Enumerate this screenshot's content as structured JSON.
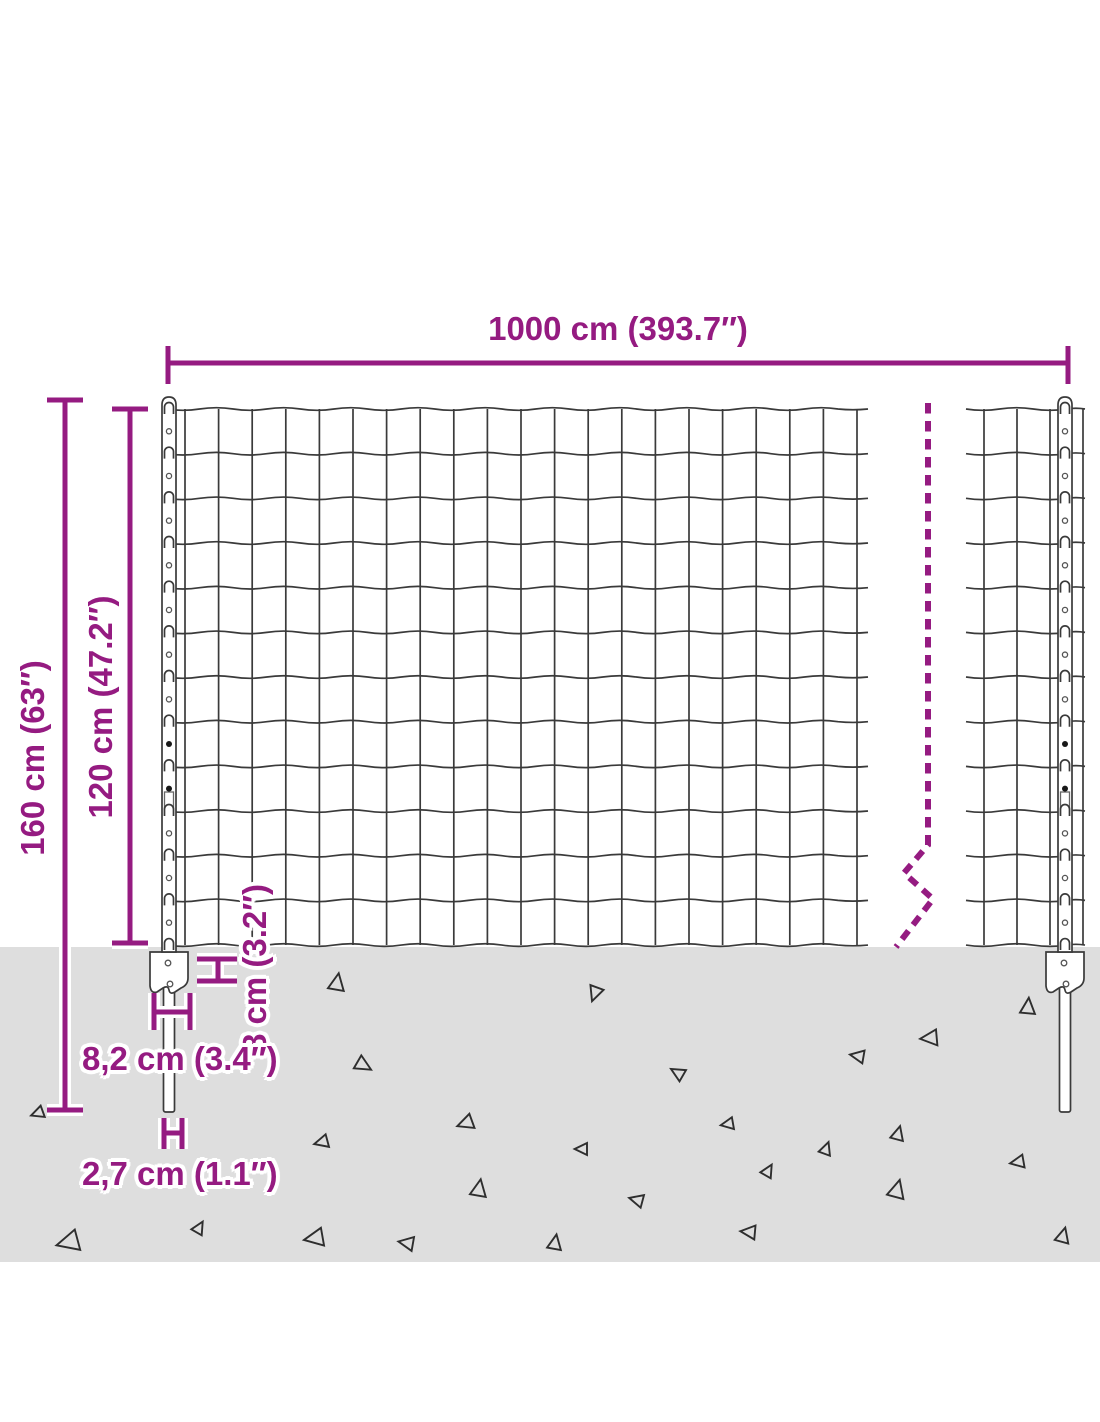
{
  "diagram": {
    "description": "Dimension diagram of a welded wire mesh fence with posts and ground anchor plates",
    "labels": {
      "width": "1000 cm (393.7″)",
      "total_height": "160 cm (63″)",
      "mesh_height": "120 cm (47.2″)",
      "anchor_plate_depth": "8 cm (3.2″)",
      "anchor_plate_width": "8,2 cm (3.4″)",
      "spike_width": "2,7 cm (1.1″)"
    },
    "colors": {
      "dimension": "#951b81",
      "ground": "#dedede",
      "wire": "#3a3a3a",
      "background": "#ffffff"
    }
  }
}
